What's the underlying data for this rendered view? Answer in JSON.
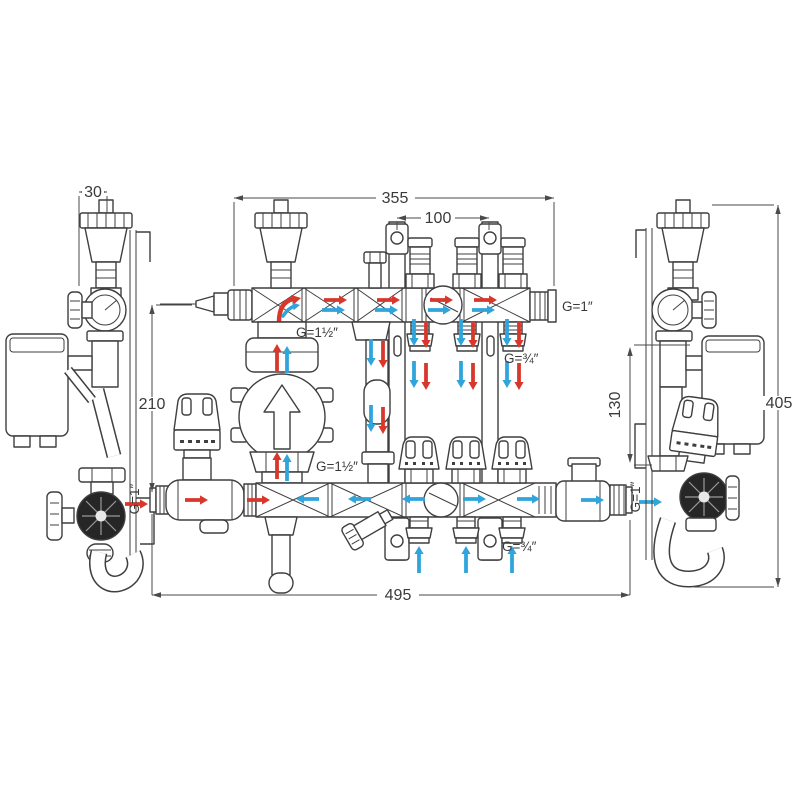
{
  "colors": {
    "line": "#3f3f3f",
    "dim": "#4a4a4a",
    "flow": "#d8382c",
    "return": "#2fa5dc",
    "valve_dark": "#262626",
    "background": "#ffffff"
  },
  "dimensions": {
    "side_offset": "30",
    "top_manifold_width": "355",
    "bracket_spacing": "100",
    "manifold_center_distance": "210",
    "return_drop": "130",
    "overall_height": "405",
    "overall_width": "495"
  },
  "connections": {
    "top_manifold_supply": "G=1½″",
    "top_manifold_end": "G=1″",
    "top_loop_outlets": "G=¾″",
    "pump_union": "G=1½″",
    "bottom_inlet": "G=1″",
    "bottom_loop_outlets": "G=¾″",
    "bottom_outlet": "G=1″"
  }
}
